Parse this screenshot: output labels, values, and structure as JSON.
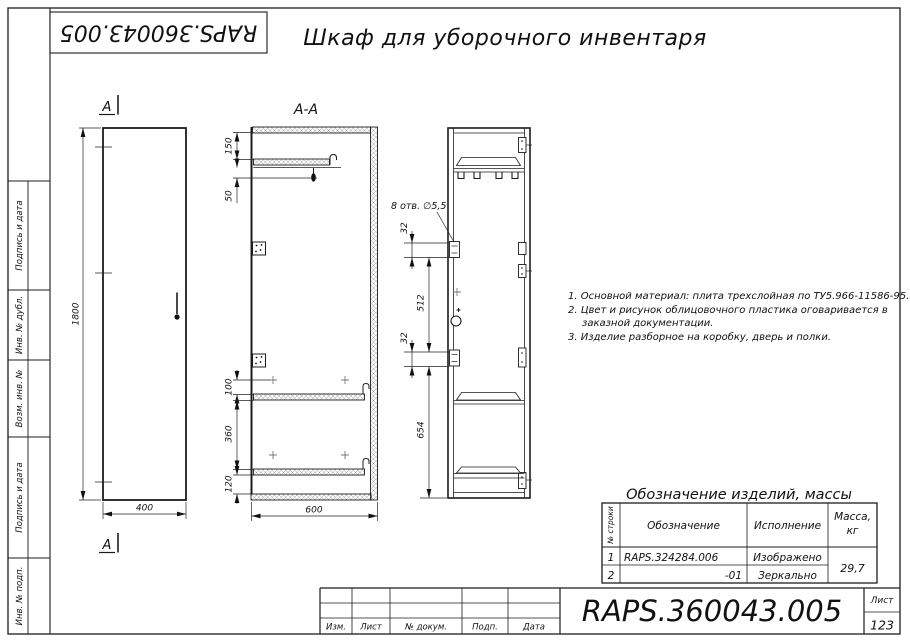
{
  "stamp": {
    "designation": "RAPS.360043.005"
  },
  "header": {
    "title": "Шкаф для уборочного инвентаря"
  },
  "sidebar": {
    "cells": [
      "Подпись и дата",
      "Инв. № дубл.",
      "Возм. инв. №",
      "Подпись и дата",
      "Инв. № подп."
    ]
  },
  "views": {
    "front": {
      "section_label_top": "А",
      "section_label_bottom": "А",
      "dim_height": "1800",
      "dim_width": "400"
    },
    "section": {
      "label": "А-А",
      "dim_top_offset": "150",
      "dim_hook": "50",
      "dim_shelf_gap": "100",
      "dim_mid": "360",
      "dim_bottom": "120",
      "dim_depth": "600"
    },
    "side": {
      "holes_label": "8 отв.  ∅5,5",
      "dim_32_top": "32",
      "dim_512": "512",
      "dim_32_bottom": "32",
      "dim_654": "654"
    }
  },
  "notes": {
    "line1": "1. Основной материал: плита трехслойная по ТУ5.966-11586-95.",
    "line2": "2. Цвет и рисунок облицовочного пластика оговаривается в",
    "line3": "заказной документации.",
    "line4": "3. Изделие разборное на коробку, дверь и полки."
  },
  "parts_table": {
    "title": "Обозначение изделий, массы",
    "headers": {
      "row_no": "№ строки",
      "designation": "Обозначение",
      "execution": "Исполнение",
      "mass_line1": "Масса,",
      "mass_line2": "кг"
    },
    "rows": [
      {
        "num": "1",
        "designation": "RAPS.324284.006",
        "execution": "Изображено"
      },
      {
        "num": "2",
        "designation": "-01",
        "execution": "Зеркально"
      }
    ],
    "mass_value": "29,7"
  },
  "title_block": {
    "designation": "RAPS.360043.005",
    "col_izm": "Изм.",
    "col_list": "Лист",
    "col_doc": "№ докум.",
    "col_sign": "Подп.",
    "col_date": "Дата",
    "sheet_label": "Лист",
    "sheet_value": "123"
  }
}
